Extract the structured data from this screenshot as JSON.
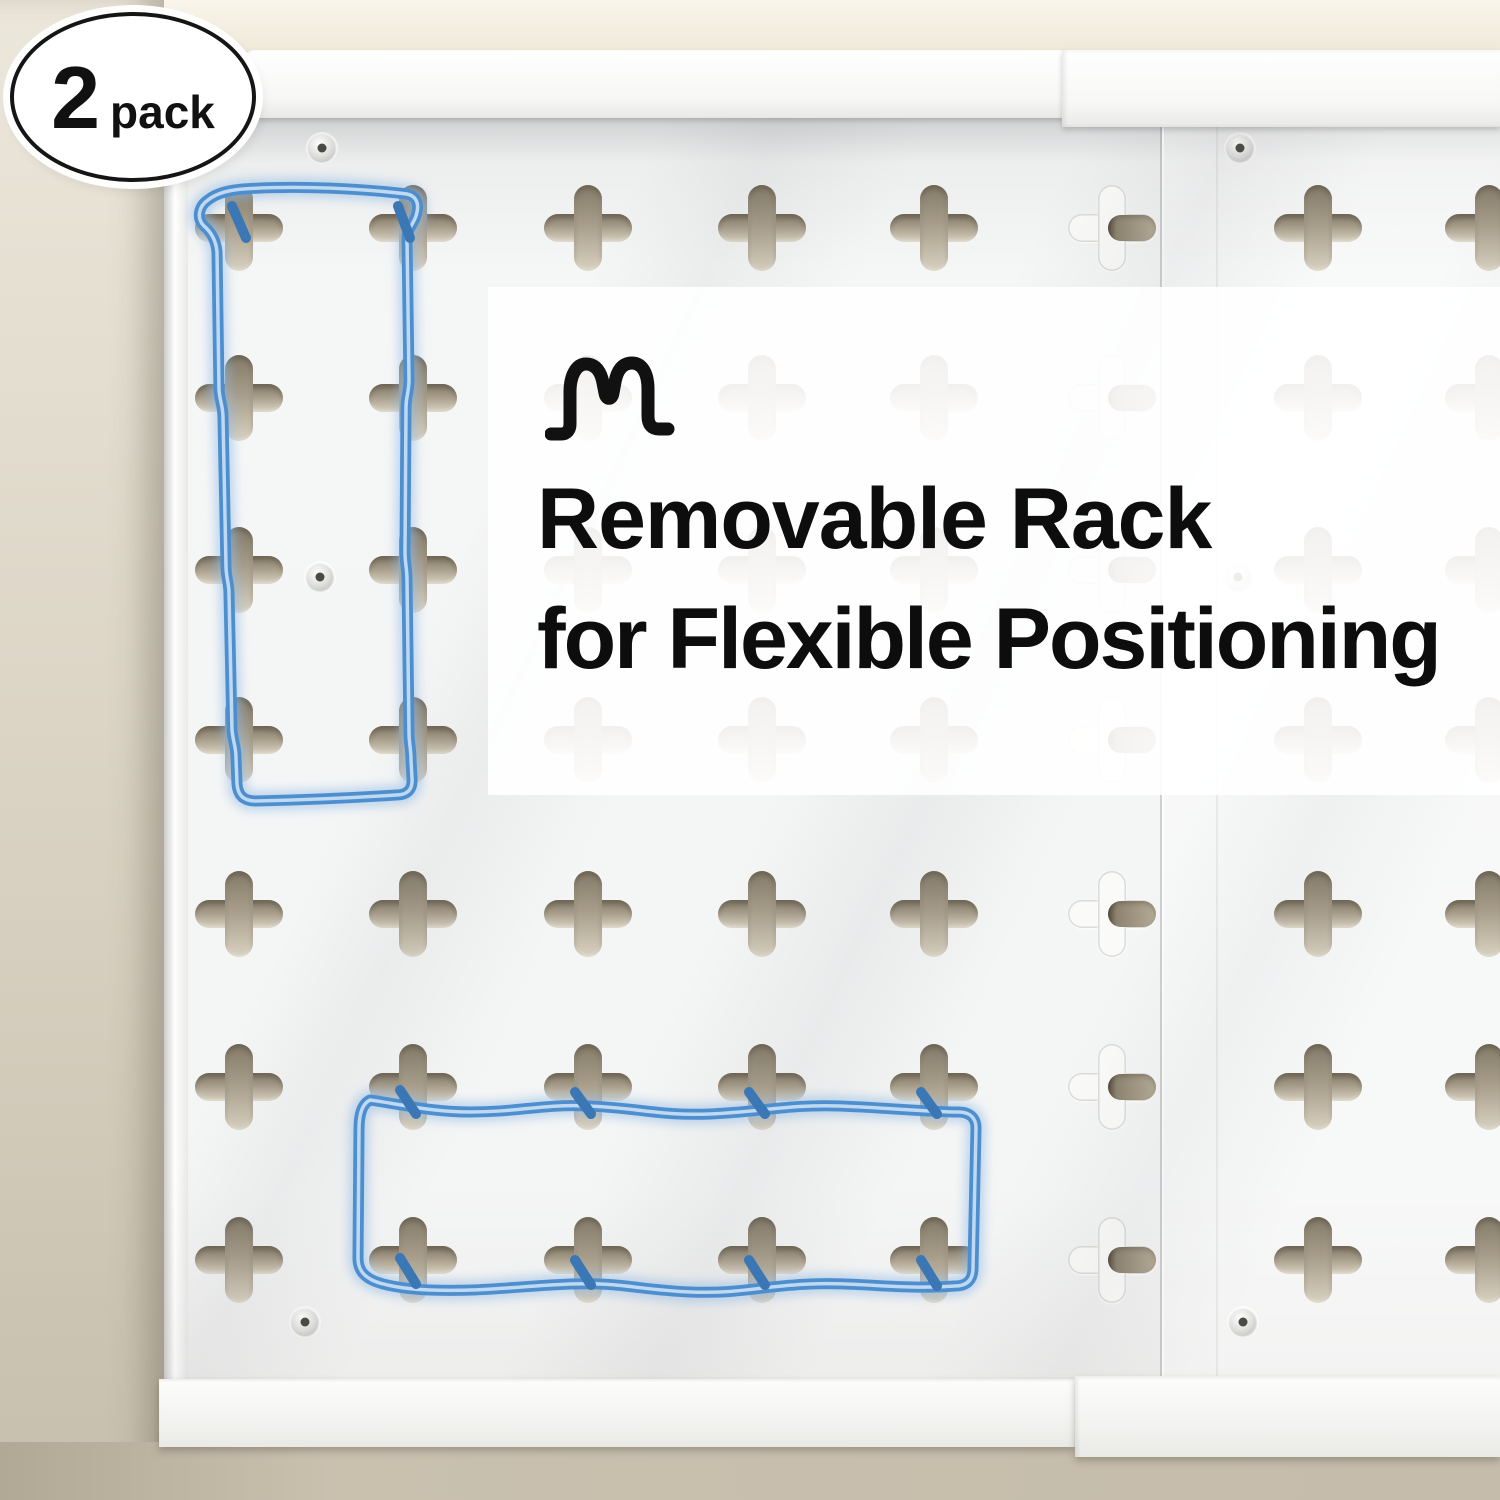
{
  "badge": {
    "count": "2",
    "label": "pack"
  },
  "headline": {
    "line1": "Removable Rack",
    "line2": "for Flexible Positioning"
  },
  "logo_icon": "brand-squiggle-m-logo",
  "scene": {
    "subject": "white wall-mounted pegboard panels with plus-shaped holes",
    "panels_shown": 2,
    "highlight": "blue wire outlines marking removable rack positions"
  },
  "colors": {
    "wall": "#cdc5b4",
    "wall_top": "#f8f4e9",
    "panel_face": "#f4f5f5",
    "hole_tan": "#a69c89",
    "wire_blue": "#4d8ecf",
    "wire_glow": "#93bce6",
    "headline_text": "#0d0d0d",
    "badge_border": "#151515",
    "overlay_white": "rgba(255,255,255,0.9)"
  }
}
